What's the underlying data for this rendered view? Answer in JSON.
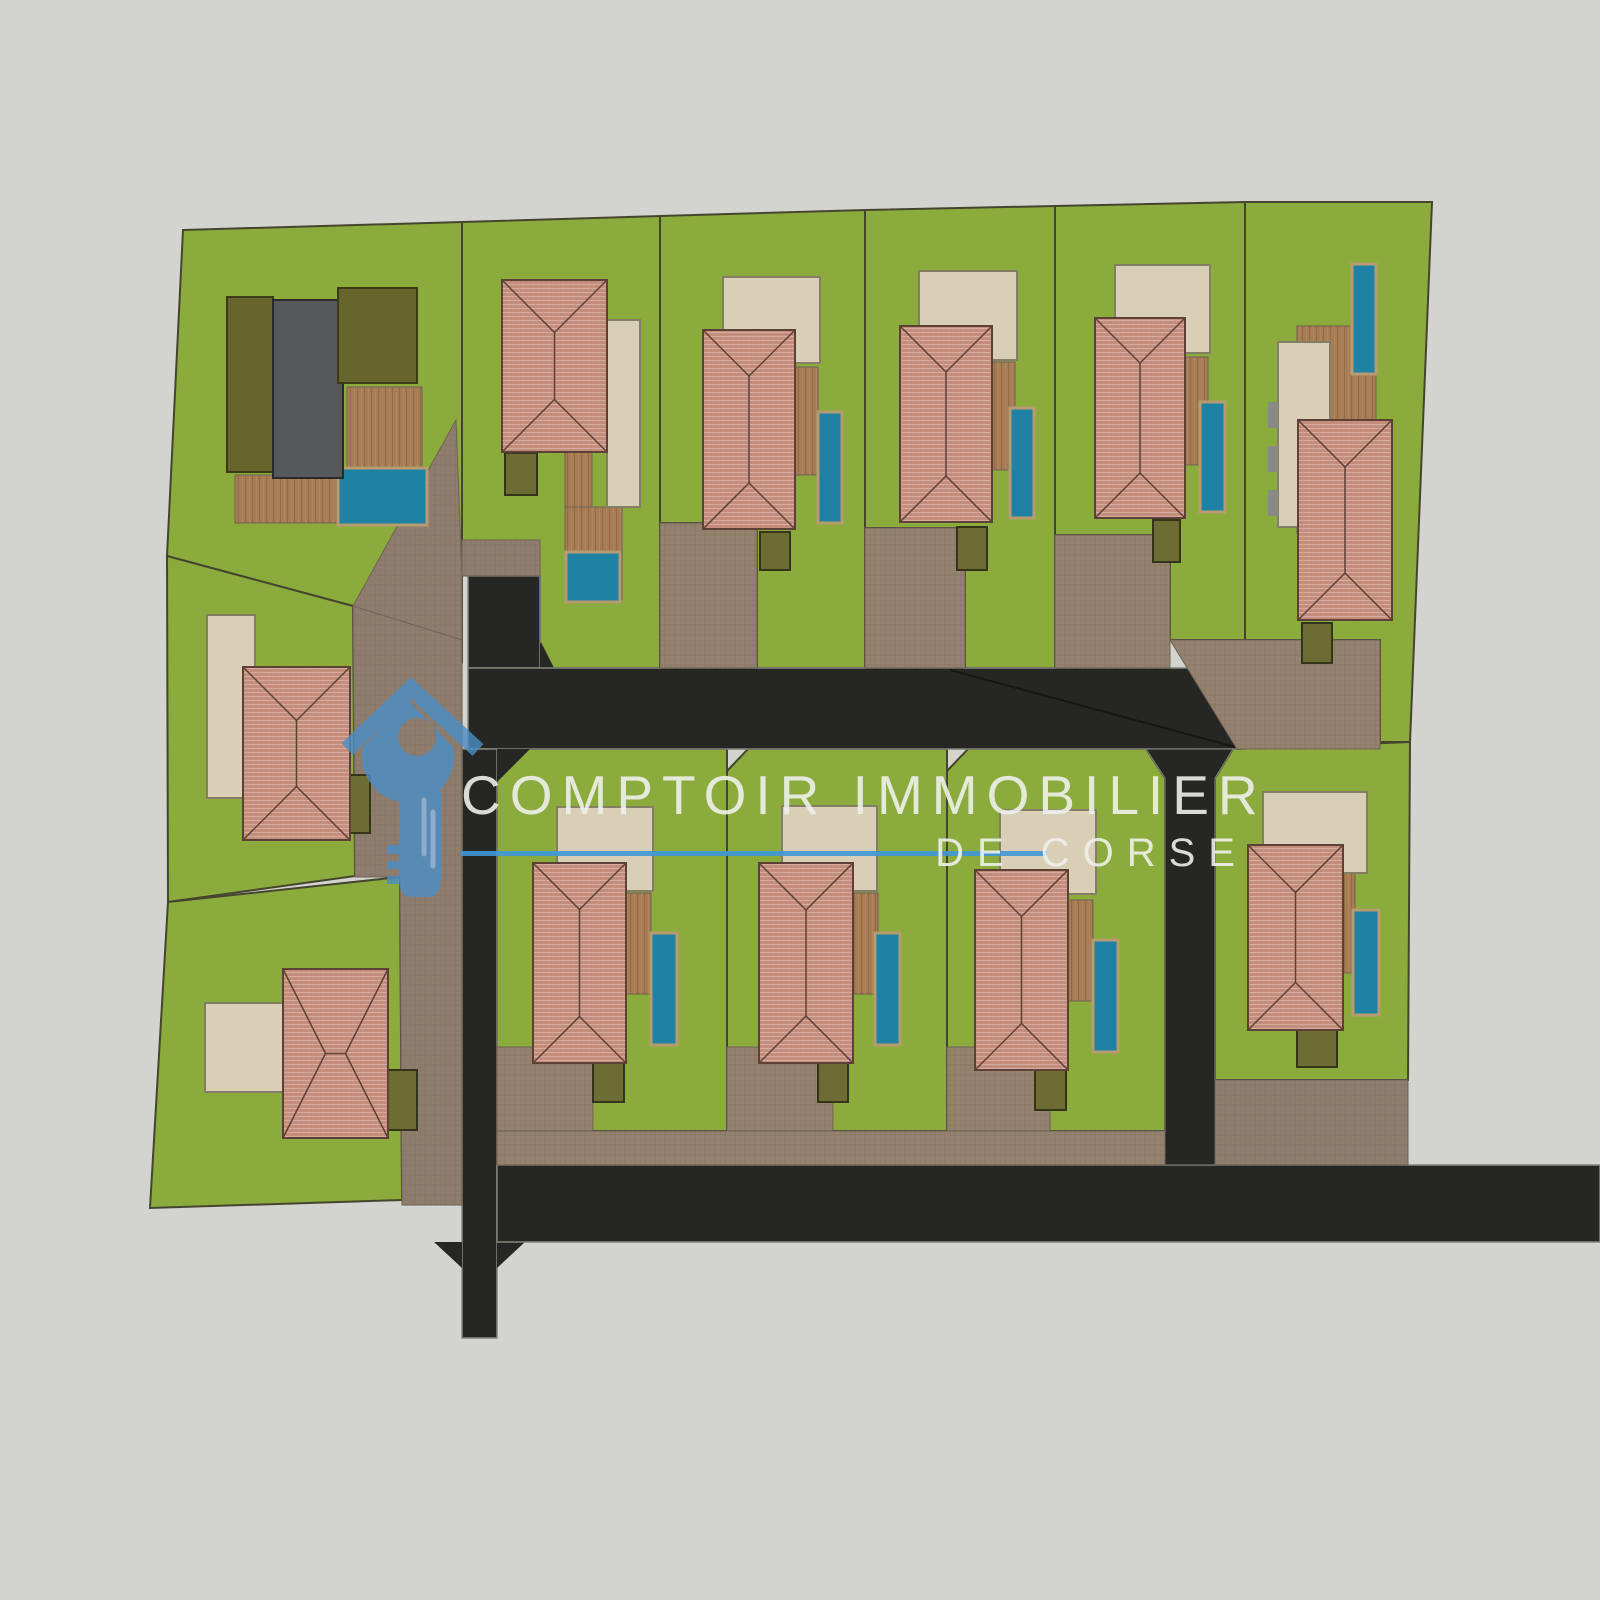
{
  "watermark": {
    "title": "COMPTOIR IMMOBILIER",
    "subtitle": "DE CORSE",
    "text_color": "rgba(238,239,235,0.9)",
    "line_color": "#3f97d8",
    "logo": {
      "color": "#4b8ec6",
      "highlight_color": "#8cbbe2",
      "opacity": 0.8,
      "paths": [
        {
          "name": "logo-house-roof",
          "d": "M347,749 L411,688 L478,750",
          "stroke_only": true,
          "sw": 16
        },
        {
          "name": "logo-key-head",
          "d": "M408,700 L453,747 A46,46 0 1 1 363,747 Z M417,737 m-19,0 a19,19 0 1 0 38,0 a19,19 0 1 0 -38,0 Z",
          "evenodd": true
        },
        {
          "name": "logo-key-shaft",
          "d": "M399,786 L399,879 Q399,897 413,897 L427,897 Q441,897 441,879 L441,786 Z"
        },
        {
          "name": "logo-key-teeth",
          "d": "M387,845 h12 v9 h-12 Z M387,861 h12 v8 h-12 Z M387,876 h12 v8 h-12 Z"
        },
        {
          "name": "logo-shaft-highlights",
          "d": "M424,800 L424,854 M433,812 L433,866",
          "stroke_only": true,
          "sw": 5,
          "cap": "round",
          "use_highlight": true
        }
      ]
    }
  },
  "colors": {
    "background": "#d3d4d0",
    "grass": "#8cab3d",
    "grass_stroke": "#45452f",
    "road": "#262624",
    "road_stroke": "#85857c",
    "seam": "#161614",
    "patio": "#d8cfb6",
    "patio_stroke": "#857e67",
    "pool": "#1f82a4",
    "pool_stroke": "#b69c6e",
    "shed": "#6d6c33",
    "shed_stroke": "#34341a",
    "roof_line": "#5d4036",
    "olive": "#66662c",
    "olive_stroke": "#3a3a16",
    "gray_building": "#57585a",
    "gray_stroke": "#2a2a2a",
    "drive_stroke": "#6e6254",
    "accent_gray": "#8a8a84"
  },
  "shapes": [
    {
      "name": "lot-1-grass",
      "type": "poly",
      "points": "183,230 462,222 462,662 353,606 167,556",
      "fill": "grass",
      "stroke": "grass_stroke",
      "sw": 2
    },
    {
      "name": "lot-2-grass",
      "type": "poly",
      "points": "462,222 660,216 660,668 553,668 540,642 540,576 462,540",
      "fill": "grass",
      "stroke": "grass_stroke",
      "sw": 2
    },
    {
      "name": "lot-3-grass",
      "type": "poly",
      "points": "660,216 865,210 865,668 757,668 757,523 660,523",
      "fill": "grass",
      "stroke": "grass_stroke",
      "sw": 2
    },
    {
      "name": "lot-4-grass",
      "type": "poly",
      "points": "865,210 1055,206 1055,668 965,668 965,528 865,528",
      "fill": "grass",
      "stroke": "grass_stroke",
      "sw": 2
    },
    {
      "name": "lot-5-grass",
      "type": "poly",
      "points": "1055,206 1245,202 1245,640 1170,640 1170,535 1055,535",
      "fill": "grass",
      "stroke": "grass_stroke",
      "sw": 2
    },
    {
      "name": "lot-6-grass",
      "type": "poly",
      "points": "1245,202 1432,202 1410,742 1380,742 1380,640 1245,640",
      "fill": "grass",
      "stroke": "grass_stroke",
      "sw": 2
    },
    {
      "name": "lot-12-grass",
      "type": "poly",
      "points": "167,556 353,606 355,876 168,902",
      "fill": "grass",
      "stroke": "grass_stroke",
      "sw": 2
    },
    {
      "name": "lot-13-grass",
      "type": "poly",
      "points": "168,902 400,877 402,1200 150,1208",
      "fill": "grass",
      "stroke": "grass_stroke",
      "sw": 2
    },
    {
      "name": "lot-b1-grass",
      "type": "poly",
      "points": "497,771 523,749 727,749 727,1131 497,1131",
      "fill": "grass",
      "stroke": "grass_stroke",
      "sw": 2
    },
    {
      "name": "lot-b2-grass",
      "type": "poly",
      "points": "727,771 748,749 947,749 947,1131 727,1131",
      "fill": "grass",
      "stroke": "grass_stroke",
      "sw": 2
    },
    {
      "name": "lot-b3-grass",
      "type": "poly",
      "points": "947,771 968,749 1146,749 1165,778 1165,1131 947,1131",
      "fill": "grass",
      "stroke": "grass_stroke",
      "sw": 2
    },
    {
      "name": "lot-b4-grass",
      "type": "poly",
      "points": "1215,778 1233,749 1410,742 1408,1080 1215,1080",
      "fill": "grass",
      "stroke": "grass_stroke",
      "sw": 2
    },
    {
      "name": "road-stem-upper",
      "type": "rect",
      "x": 468,
      "y": 576,
      "w": 72,
      "h": 92,
      "fill": "road",
      "stroke": "road_stroke",
      "sw": 1.5
    },
    {
      "name": "road-flare-upper",
      "type": "poly",
      "points": "540,642 554,668 540,668",
      "fill": "road"
    },
    {
      "name": "road-main",
      "type": "rect",
      "x": 468,
      "y": 668,
      "w": 769,
      "h": 81,
      "fill": "road",
      "stroke": "road_stroke",
      "sw": 1.5
    },
    {
      "name": "road-stem-lower",
      "type": "rect",
      "x": 462,
      "y": 749,
      "w": 35,
      "h": 589,
      "fill": "road",
      "stroke": "road_stroke",
      "sw": 1.5
    },
    {
      "name": "road-flare-e1",
      "type": "poly",
      "points": "497,749 530,749 497,782",
      "fill": "road"
    },
    {
      "name": "road-flare-ne",
      "type": "poly",
      "points": "497,1140 525,1165 497,1165",
      "fill": "road"
    },
    {
      "name": "road-flare-se",
      "type": "poly",
      "points": "497,1242 525,1242 497,1268",
      "fill": "road"
    },
    {
      "name": "road-flare-nw",
      "type": "poly",
      "points": "462,1140 462,1165 434,1165",
      "fill": "road"
    },
    {
      "name": "road-flare-sw",
      "type": "poly",
      "points": "462,1242 434,1242 462,1268",
      "fill": "road"
    },
    {
      "name": "road-south",
      "type": "rect",
      "x": 497,
      "y": 1165,
      "w": 1103,
      "h": 77,
      "fill": "road",
      "stroke": "road_stroke",
      "sw": 1.5
    },
    {
      "name": "road-stem-mid",
      "type": "poly",
      "points": "1146,749 1233,749 1215,778 1215,1165 1165,1165 1165,778",
      "fill": "road",
      "stroke": "road_stroke",
      "sw": 1
    },
    {
      "name": "road-seam-line",
      "type": "line",
      "points": "950,670 1235,747",
      "stroke": "seam",
      "sw": 2
    },
    {
      "name": "driveway-lot1-wedge",
      "type": "poly",
      "points": "456,420 462,576 462,662 353,606",
      "fill": "paverA",
      "stroke": "drive_stroke",
      "sw": 1
    },
    {
      "name": "driveway-west-strip",
      "type": "poly",
      "points": "353,606 462,640 462,1205 402,1205 400,877 355,877",
      "fill": "paverA",
      "stroke": "drive_stroke",
      "sw": 1
    },
    {
      "name": "driveway-lot2",
      "type": "rect",
      "x": 462,
      "y": 540,
      "w": 78,
      "h": 36,
      "fill": "paverA",
      "stroke": "drive_stroke",
      "sw": 1
    },
    {
      "name": "driveway-lot3",
      "type": "rect",
      "x": 660,
      "y": 523,
      "w": 97,
      "h": 145,
      "fill": "paverB",
      "stroke": "drive_stroke",
      "sw": 1
    },
    {
      "name": "driveway-lot4",
      "type": "rect",
      "x": 865,
      "y": 528,
      "w": 100,
      "h": 140,
      "fill": "paverB",
      "stroke": "drive_stroke",
      "sw": 1
    },
    {
      "name": "driveway-lot5",
      "type": "rect",
      "x": 1055,
      "y": 535,
      "w": 115,
      "h": 133,
      "fill": "paverB",
      "stroke": "drive_stroke",
      "sw": 1
    },
    {
      "name": "driveway-east-band",
      "type": "poly",
      "points": "1170,640 1380,640 1380,749 1237,749",
      "fill": "paverB",
      "stroke": "drive_stroke",
      "sw": 1
    },
    {
      "name": "driveway-south-band",
      "type": "rect",
      "x": 497,
      "y": 1131,
      "w": 668,
      "h": 34,
      "fill": "paverB",
      "stroke": "drive_stroke",
      "sw": 1
    },
    {
      "name": "driveway-b1",
      "type": "rect",
      "x": 497,
      "y": 1047,
      "w": 96,
      "h": 84,
      "fill": "paverB",
      "stroke": "drive_stroke",
      "sw": 1
    },
    {
      "name": "driveway-b2",
      "type": "rect",
      "x": 727,
      "y": 1047,
      "w": 106,
      "h": 84,
      "fill": "paverB",
      "stroke": "drive_stroke",
      "sw": 1
    },
    {
      "name": "driveway-b3",
      "type": "rect",
      "x": 947,
      "y": 1047,
      "w": 103,
      "h": 84,
      "fill": "paverB",
      "stroke": "drive_stroke",
      "sw": 1
    },
    {
      "name": "driveway-b4",
      "type": "rect",
      "x": 1215,
      "y": 1080,
      "w": 193,
      "h": 85,
      "fill": "paverA",
      "stroke": "drive_stroke",
      "sw": 1
    },
    {
      "name": "deck-lot1-east",
      "type": "rect",
      "x": 347,
      "y": 387,
      "w": 75,
      "h": 80,
      "fill": "wood",
      "stroke": "drive_stroke",
      "sw": 1
    },
    {
      "name": "deck-lot1-south",
      "type": "rect",
      "x": 235,
      "y": 475,
      "w": 103,
      "h": 48,
      "fill": "wood",
      "stroke": "drive_stroke",
      "sw": 1
    },
    {
      "name": "deck-lot2-a",
      "type": "rect",
      "x": 565,
      "y": 452,
      "w": 27,
      "h": 57,
      "fill": "wood",
      "stroke": "drive_stroke",
      "sw": 1
    },
    {
      "name": "deck-lot2-b",
      "type": "rect",
      "x": 565,
      "y": 507,
      "w": 57,
      "h": 93,
      "fill": "wood",
      "stroke": "drive_stroke",
      "sw": 1
    },
    {
      "name": "deck-lot3",
      "type": "rect",
      "x": 795,
      "y": 367,
      "w": 23,
      "h": 108,
      "fill": "wood",
      "stroke": "drive_stroke",
      "sw": 1
    },
    {
      "name": "deck-lot4",
      "type": "rect",
      "x": 992,
      "y": 362,
      "w": 23,
      "h": 108,
      "fill": "wood",
      "stroke": "drive_stroke",
      "sw": 1
    },
    {
      "name": "deck-lot5",
      "type": "rect",
      "x": 1185,
      "y": 357,
      "w": 23,
      "h": 108,
      "fill": "wood",
      "stroke": "drive_stroke",
      "sw": 1
    },
    {
      "name": "deck-lot6",
      "type": "rect",
      "x": 1297,
      "y": 326,
      "w": 79,
      "h": 207,
      "fill": "wood",
      "stroke": "drive_stroke",
      "sw": 1
    },
    {
      "name": "deck-b1",
      "type": "rect",
      "x": 626,
      "y": 893,
      "w": 25,
      "h": 101,
      "fill": "wood",
      "stroke": "drive_stroke",
      "sw": 1
    },
    {
      "name": "deck-b2",
      "type": "rect",
      "x": 853,
      "y": 893,
      "w": 25,
      "h": 101,
      "fill": "wood",
      "stroke": "drive_stroke",
      "sw": 1
    },
    {
      "name": "deck-b3",
      "type": "rect",
      "x": 1068,
      "y": 900,
      "w": 25,
      "h": 101,
      "fill": "wood",
      "stroke": "drive_stroke",
      "sw": 1
    },
    {
      "name": "deck-b4",
      "type": "rect",
      "x": 1343,
      "y": 873,
      "w": 12,
      "h": 100,
      "fill": "wood",
      "stroke": "drive_stroke",
      "sw": 1
    },
    {
      "name": "patio-lot2",
      "type": "rect",
      "x": 607,
      "y": 320,
      "w": 33,
      "h": 187,
      "fill": "patio",
      "stroke": "patio_stroke",
      "sw": 2
    },
    {
      "name": "patio-lot3",
      "type": "rect",
      "x": 723,
      "y": 277,
      "w": 97,
      "h": 86,
      "fill": "patio",
      "stroke": "patio_stroke",
      "sw": 2
    },
    {
      "name": "patio-lot4",
      "type": "rect",
      "x": 919,
      "y": 271,
      "w": 98,
      "h": 89,
      "fill": "patio",
      "stroke": "patio_stroke",
      "sw": 2
    },
    {
      "name": "patio-lot5",
      "type": "rect",
      "x": 1115,
      "y": 265,
      "w": 95,
      "h": 88,
      "fill": "patio",
      "stroke": "patio_stroke",
      "sw": 2
    },
    {
      "name": "patio-lot6",
      "type": "rect",
      "x": 1278,
      "y": 342,
      "w": 52,
      "h": 185,
      "fill": "patio",
      "stroke": "patio_stroke",
      "sw": 2
    },
    {
      "name": "patio-lot12",
      "type": "rect",
      "x": 207,
      "y": 615,
      "w": 48,
      "h": 183,
      "fill": "patio",
      "stroke": "patio_stroke",
      "sw": 2
    },
    {
      "name": "patio-lot13",
      "type": "rect",
      "x": 205,
      "y": 1003,
      "w": 78,
      "h": 89,
      "fill": "patio",
      "stroke": "patio_stroke",
      "sw": 2
    },
    {
      "name": "patio-b1",
      "type": "rect",
      "x": 557,
      "y": 807,
      "w": 96,
      "h": 84,
      "fill": "patio",
      "stroke": "patio_stroke",
      "sw": 2
    },
    {
      "name": "patio-b2",
      "type": "rect",
      "x": 782,
      "y": 806,
      "w": 95,
      "h": 85,
      "fill": "patio",
      "stroke": "patio_stroke",
      "sw": 2
    },
    {
      "name": "patio-b3",
      "type": "rect",
      "x": 1000,
      "y": 810,
      "w": 96,
      "h": 84,
      "fill": "patio",
      "stroke": "patio_stroke",
      "sw": 2
    },
    {
      "name": "patio-b4",
      "type": "rect",
      "x": 1263,
      "y": 792,
      "w": 104,
      "h": 81,
      "fill": "patio",
      "stroke": "patio_stroke",
      "sw": 2
    },
    {
      "name": "patio-lot6-step-1",
      "type": "rect",
      "x": 1268,
      "y": 402,
      "w": 10,
      "h": 26,
      "fill": "accent_gray"
    },
    {
      "name": "patio-lot6-step-2",
      "type": "rect",
      "x": 1268,
      "y": 446,
      "w": 10,
      "h": 26,
      "fill": "accent_gray"
    },
    {
      "name": "patio-lot6-step-3",
      "type": "rect",
      "x": 1268,
      "y": 490,
      "w": 10,
      "h": 26,
      "fill": "accent_gray"
    },
    {
      "name": "pool-lot1",
      "type": "rect",
      "x": 338,
      "y": 468,
      "w": 89,
      "h": 57,
      "fill": "pool",
      "stroke": "pool_stroke",
      "sw": 3
    },
    {
      "name": "pool-lot2",
      "type": "rect",
      "x": 566,
      "y": 552,
      "w": 54,
      "h": 50,
      "fill": "pool",
      "stroke": "pool_stroke",
      "sw": 3
    },
    {
      "name": "pool-lot3",
      "type": "rect",
      "x": 818,
      "y": 412,
      "w": 24,
      "h": 111,
      "fill": "pool",
      "stroke": "pool_stroke",
      "sw": 3
    },
    {
      "name": "pool-lot4",
      "type": "rect",
      "x": 1010,
      "y": 408,
      "w": 24,
      "h": 110,
      "fill": "pool",
      "stroke": "pool_stroke",
      "sw": 3
    },
    {
      "name": "pool-lot5",
      "type": "rect",
      "x": 1200,
      "y": 402,
      "w": 25,
      "h": 110,
      "fill": "pool",
      "stroke": "pool_stroke",
      "sw": 3
    },
    {
      "name": "pool-lot6",
      "type": "rect",
      "x": 1352,
      "y": 264,
      "w": 24,
      "h": 110,
      "fill": "pool",
      "stroke": "pool_stroke",
      "sw": 3
    },
    {
      "name": "pool-b1",
      "type": "rect",
      "x": 651,
      "y": 933,
      "w": 26,
      "h": 112,
      "fill": "pool",
      "stroke": "pool_stroke",
      "sw": 3
    },
    {
      "name": "pool-b2",
      "type": "rect",
      "x": 875,
      "y": 933,
      "w": 25,
      "h": 112,
      "fill": "pool",
      "stroke": "pool_stroke",
      "sw": 3
    },
    {
      "name": "pool-b3",
      "type": "rect",
      "x": 1093,
      "y": 940,
      "w": 25,
      "h": 112,
      "fill": "pool",
      "stroke": "pool_stroke",
      "sw": 3
    },
    {
      "name": "pool-b4",
      "type": "rect",
      "x": 1353,
      "y": 910,
      "w": 26,
      "h": 105,
      "fill": "pool",
      "stroke": "pool_stroke",
      "sw": 3
    },
    {
      "name": "shed-lot2",
      "type": "rect",
      "x": 505,
      "y": 453,
      "w": 32,
      "h": 42,
      "fill": "shed",
      "stroke": "shed_stroke",
      "sw": 2
    },
    {
      "name": "shed-lot3",
      "type": "rect",
      "x": 760,
      "y": 532,
      "w": 30,
      "h": 38,
      "fill": "shed",
      "stroke": "shed_stroke",
      "sw": 2
    },
    {
      "name": "shed-lot4",
      "type": "rect",
      "x": 957,
      "y": 527,
      "w": 30,
      "h": 43,
      "fill": "shed",
      "stroke": "shed_stroke",
      "sw": 2
    },
    {
      "name": "shed-lot5",
      "type": "rect",
      "x": 1153,
      "y": 520,
      "w": 27,
      "h": 42,
      "fill": "shed",
      "stroke": "shed_stroke",
      "sw": 2
    },
    {
      "name": "shed-lot6",
      "type": "rect",
      "x": 1302,
      "y": 623,
      "w": 30,
      "h": 40,
      "fill": "shed",
      "stroke": "shed_stroke",
      "sw": 2
    },
    {
      "name": "shed-lot12",
      "type": "rect",
      "x": 349,
      "y": 775,
      "w": 21,
      "h": 58,
      "fill": "shed",
      "stroke": "shed_stroke",
      "sw": 2
    },
    {
      "name": "shed-lot13",
      "type": "rect",
      "x": 388,
      "y": 1070,
      "w": 29,
      "h": 60,
      "fill": "shed",
      "stroke": "shed_stroke",
      "sw": 2
    },
    {
      "name": "shed-b1",
      "type": "rect",
      "x": 593,
      "y": 1062,
      "w": 31,
      "h": 40,
      "fill": "shed",
      "stroke": "shed_stroke",
      "sw": 2
    },
    {
      "name": "shed-b2",
      "type": "rect",
      "x": 818,
      "y": 1063,
      "w": 30,
      "h": 39,
      "fill": "shed",
      "stroke": "shed_stroke",
      "sw": 2
    },
    {
      "name": "shed-b3",
      "type": "rect",
      "x": 1035,
      "y": 1070,
      "w": 31,
      "h": 40,
      "fill": "shed",
      "stroke": "shed_stroke",
      "sw": 2
    },
    {
      "name": "shed-b4",
      "type": "rect",
      "x": 1297,
      "y": 1030,
      "w": 40,
      "h": 37,
      "fill": "shed",
      "stroke": "shed_stroke",
      "sw": 2
    },
    {
      "name": "building-lot1-olive-west",
      "type": "rect",
      "x": 227,
      "y": 297,
      "w": 46,
      "h": 175,
      "fill": "olive",
      "stroke": "olive_stroke",
      "sw": 2
    },
    {
      "name": "building-lot1-gray-core",
      "type": "rect",
      "x": 273,
      "y": 300,
      "w": 70,
      "h": 178,
      "fill": "gray_building",
      "stroke": "gray_stroke",
      "sw": 2
    },
    {
      "name": "building-lot1-olive-east",
      "type": "rect",
      "x": 338,
      "y": 288,
      "w": 79,
      "h": 95,
      "fill": "olive",
      "stroke": "olive_stroke",
      "sw": 2
    },
    {
      "name": "house-lot2",
      "type": "hiproof",
      "x": 502,
      "y": 280,
      "w": 105,
      "h": 172,
      "ridge": "v"
    },
    {
      "name": "house-lot3",
      "type": "hiproof",
      "x": 703,
      "y": 330,
      "w": 92,
      "h": 199,
      "ridge": "v"
    },
    {
      "name": "house-lot4",
      "type": "hiproof",
      "x": 900,
      "y": 326,
      "w": 92,
      "h": 196,
      "ridge": "v"
    },
    {
      "name": "house-lot5",
      "type": "hiproof",
      "x": 1095,
      "y": 318,
      "w": 90,
      "h": 200,
      "ridge": "v"
    },
    {
      "name": "house-lot6",
      "type": "hiproof",
      "x": 1298,
      "y": 420,
      "w": 94,
      "h": 200,
      "ridge": "v"
    },
    {
      "name": "house-lot12",
      "type": "hiproof",
      "x": 243,
      "y": 667,
      "w": 107,
      "h": 173,
      "ridge": "v"
    },
    {
      "name": "house-lot13",
      "type": "hiproof",
      "x": 283,
      "y": 969,
      "w": 105,
      "h": 169,
      "ridge": "h"
    },
    {
      "name": "house-b1",
      "type": "hiproof",
      "x": 533,
      "y": 863,
      "w": 93,
      "h": 200,
      "ridge": "v"
    },
    {
      "name": "house-b2",
      "type": "hiproof",
      "x": 759,
      "y": 863,
      "w": 94,
      "h": 200,
      "ridge": "v"
    },
    {
      "name": "house-b3",
      "type": "hiproof",
      "x": 975,
      "y": 870,
      "w": 93,
      "h": 200,
      "ridge": "v"
    },
    {
      "name": "house-b4",
      "type": "hiproof",
      "x": 1248,
      "y": 845,
      "w": 95,
      "h": 185,
      "ridge": "v"
    }
  ]
}
